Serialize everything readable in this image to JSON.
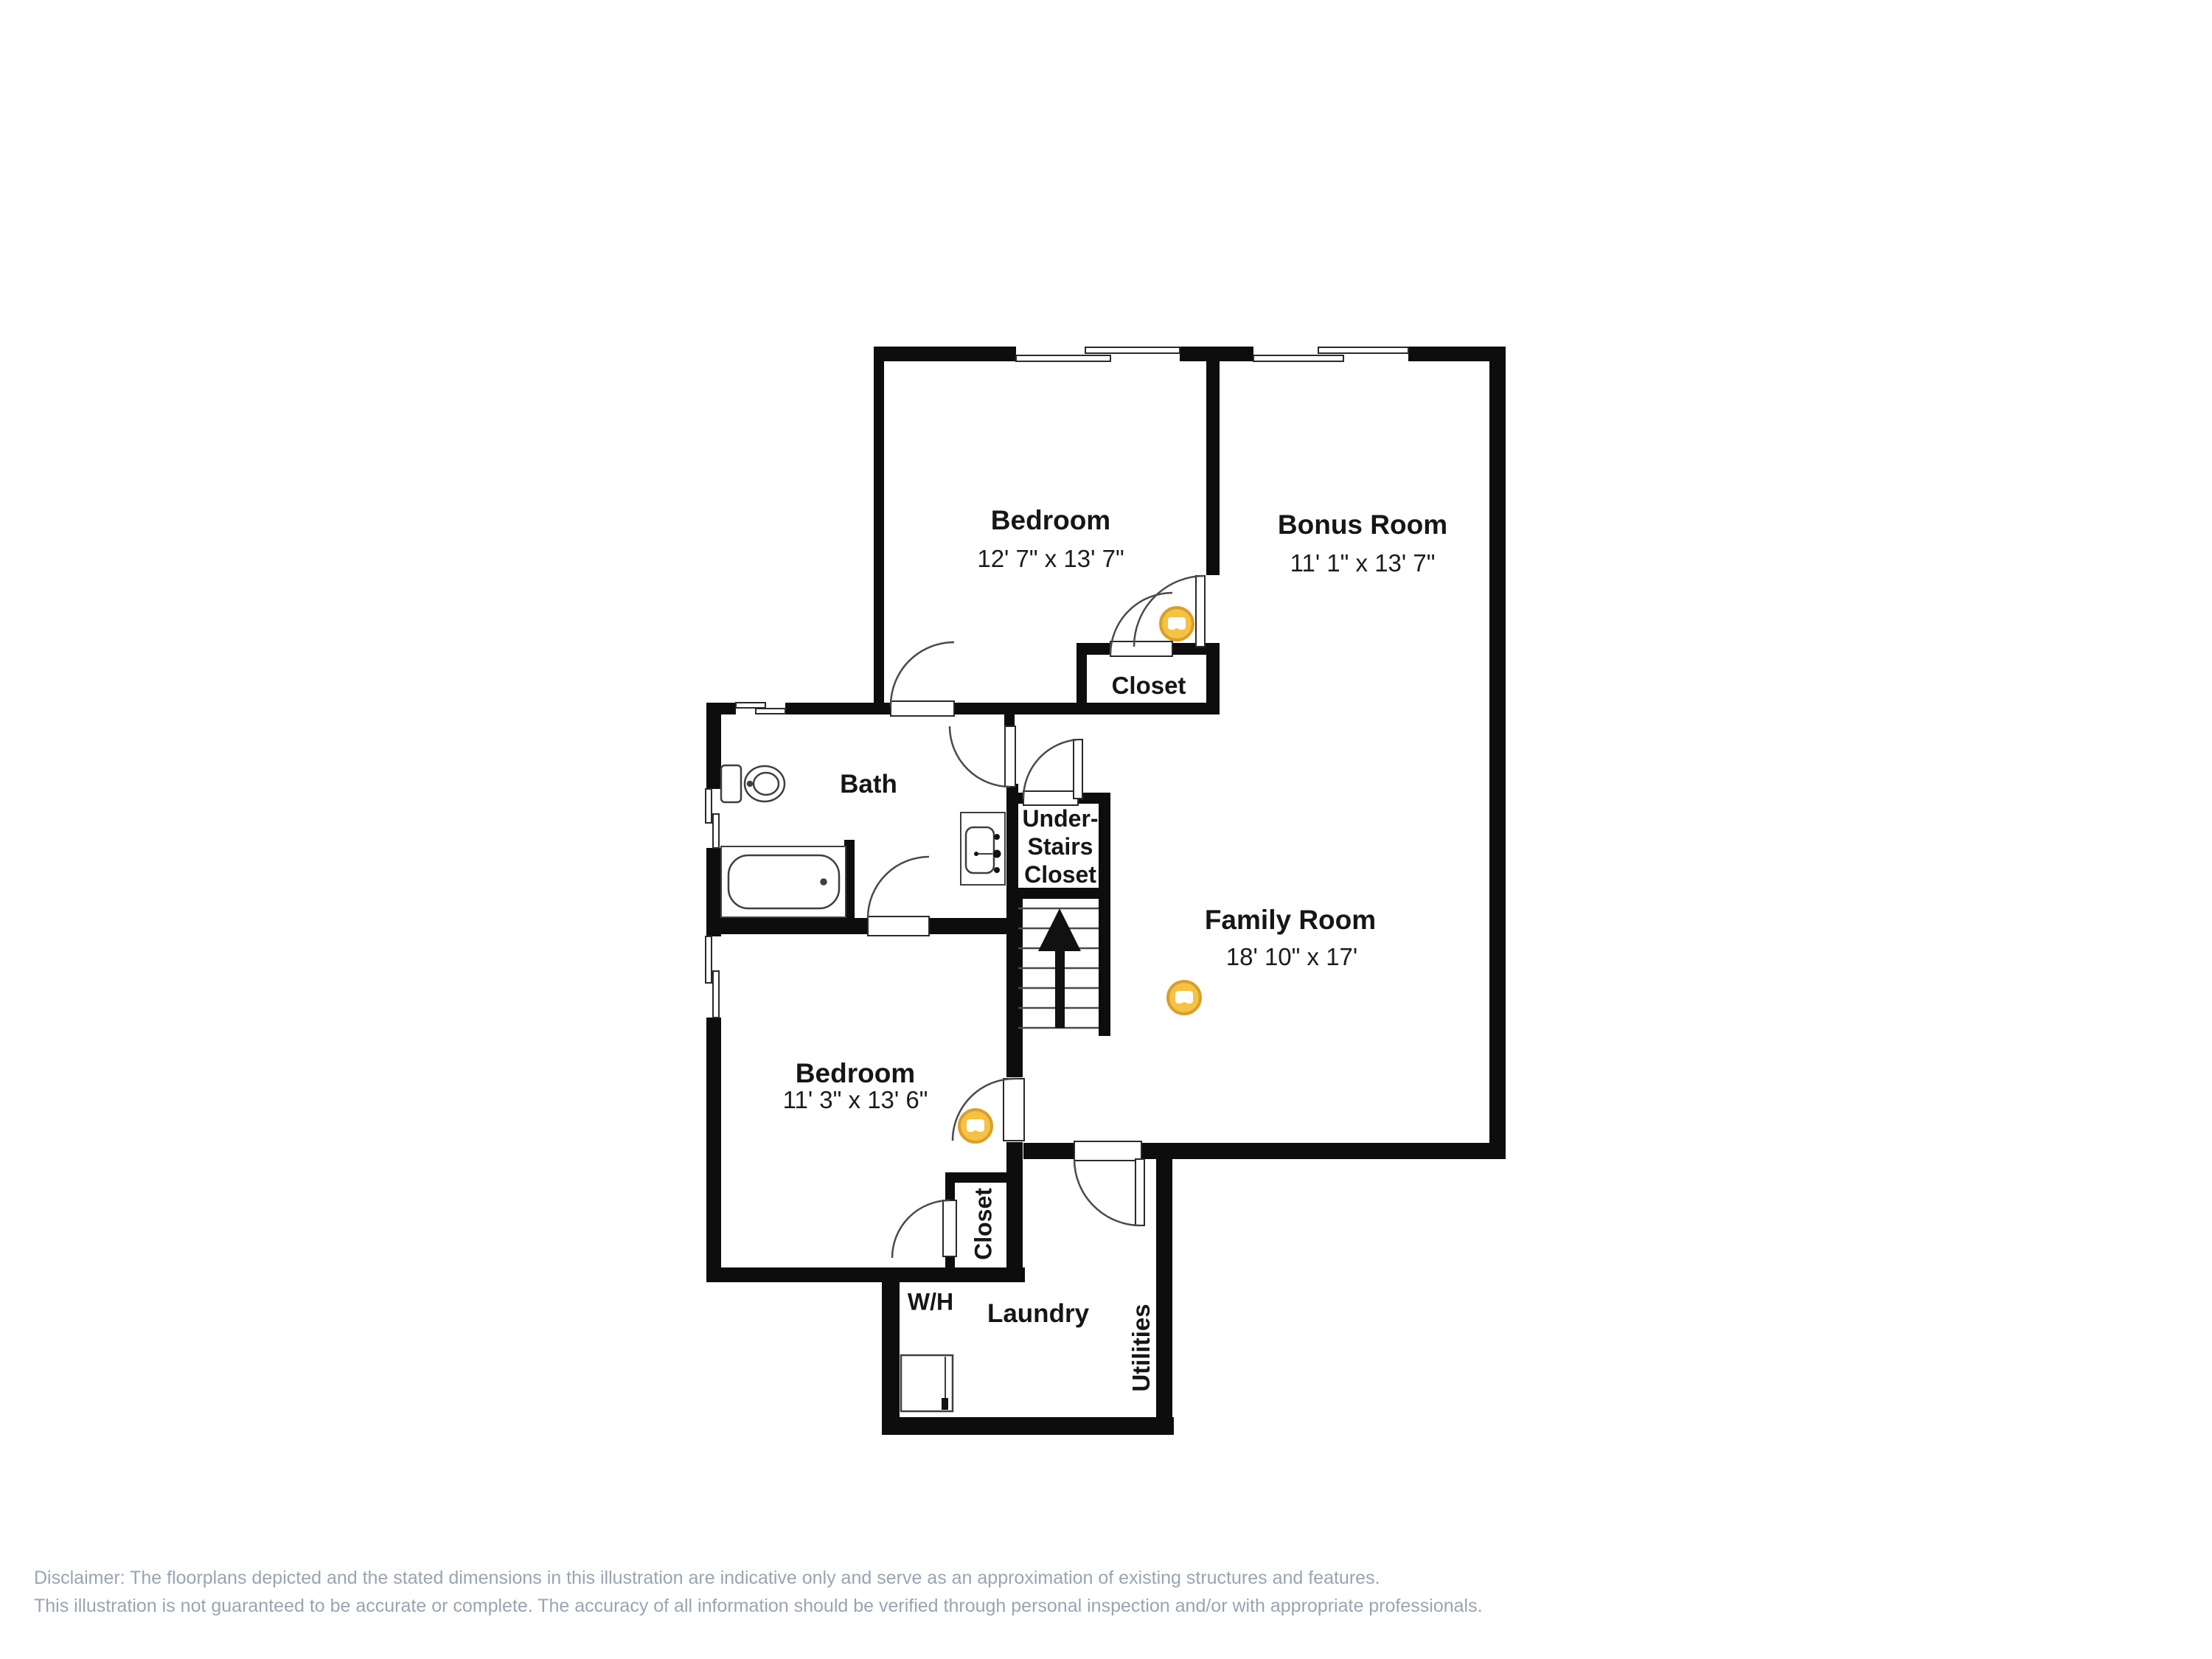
{
  "rooms": {
    "bedroom_top": {
      "name": "Bedroom",
      "dims": "12' 7\" x 13' 7\""
    },
    "bonus_room": {
      "name": "Bonus Room",
      "dims": "11' 1\" x 13' 7\""
    },
    "closet_top": {
      "name": "Closet"
    },
    "bath": {
      "name": "Bath"
    },
    "under_stairs_closet": {
      "lines": [
        "Under-",
        "Stairs",
        "Closet"
      ]
    },
    "family_room": {
      "name": "Family Room",
      "dims": "18' 10\" x 17'"
    },
    "bedroom_bottom": {
      "name": "Bedroom",
      "dims": "11' 3\" x 13' 6\""
    },
    "closet_bottom": {
      "name": "Closet"
    },
    "water_heater_label": "W/H",
    "laundry": {
      "name": "Laundry"
    },
    "utilities": {
      "name": "Utilities"
    }
  },
  "markers": {
    "count": 3,
    "fill": "#F5C243",
    "ring": "#DA9E2B"
  },
  "colors": {
    "wall": "#0d0d0d",
    "line": "#3f3f3f",
    "label": "#161616",
    "disclaimer": "#9aa4b1",
    "background": "#ffffff"
  },
  "disclaimer": {
    "line1": "Disclaimer: The floorplans depicted and the stated dimensions in this illustration are indicative only and serve as an approximation of existing structures and features.",
    "line2": "This illustration is not guaranteed to be accurate or complete. The accuracy of all information should be verified through personal inspection and/or with appropriate professionals."
  }
}
